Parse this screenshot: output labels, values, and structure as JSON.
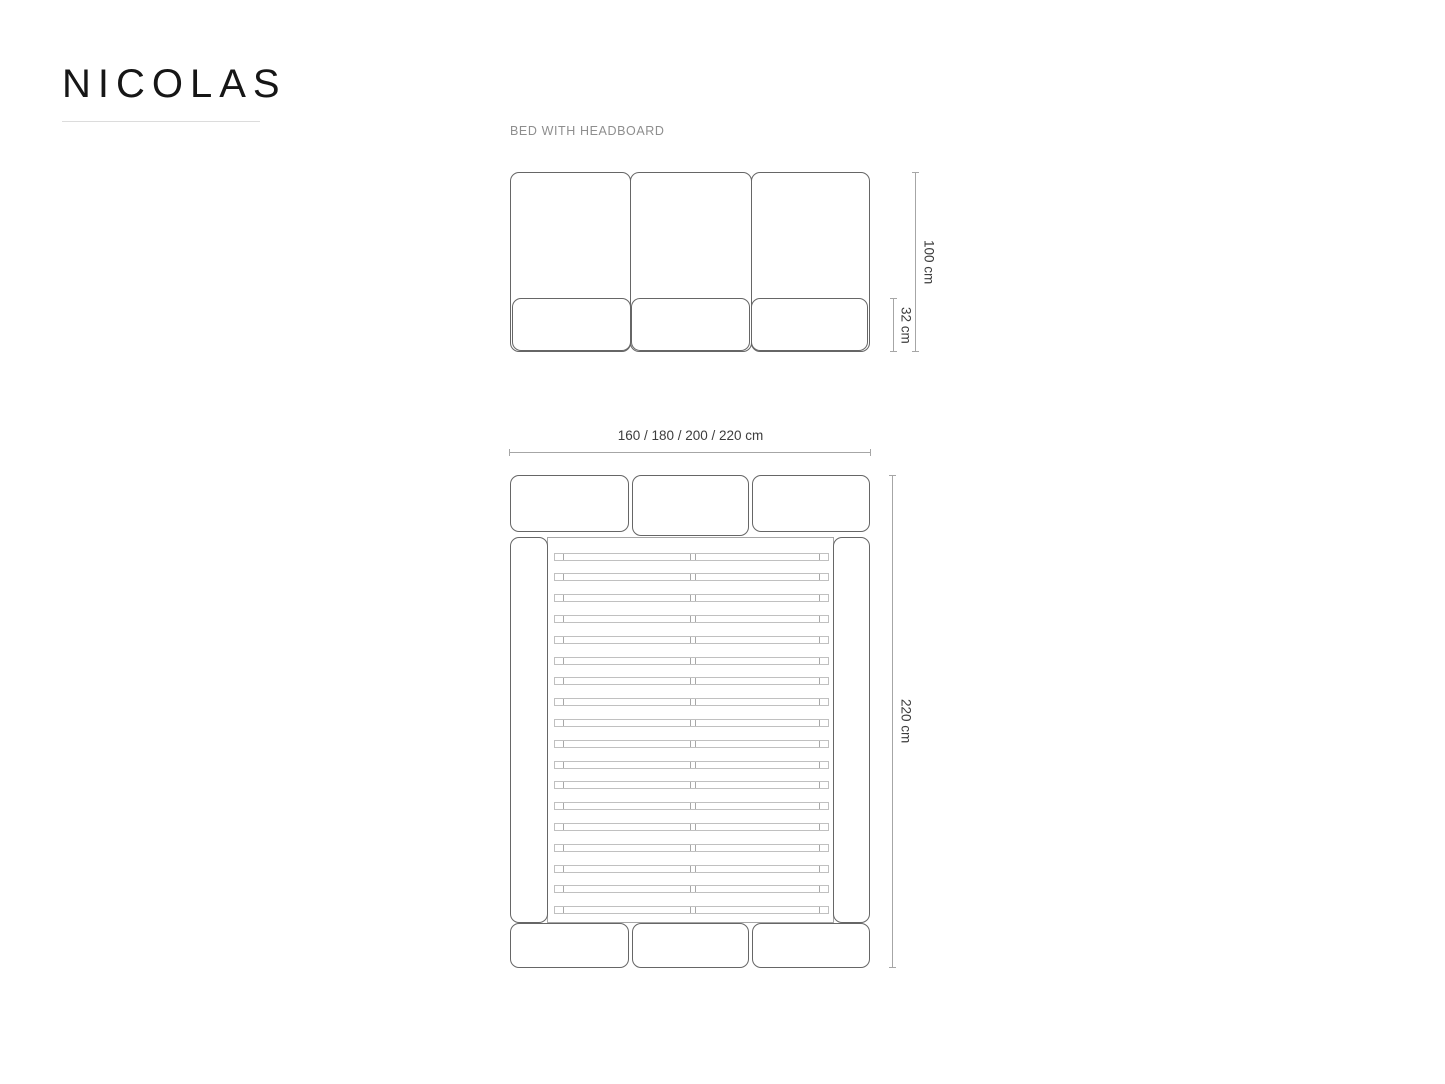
{
  "brand": {
    "name": "NICOLAS"
  },
  "product": {
    "label": "BED WITH HEADBOARD"
  },
  "front_view": {
    "total_height": "100 cm",
    "base_height": "32 cm"
  },
  "top_view": {
    "width_options": "160 / 180 / 200 / 220 cm",
    "length": "220 cm",
    "slat_count": 18
  },
  "colors": {
    "brand": "#161616",
    "outline": "#666666",
    "dim": "#a6a6a6",
    "slat": "#c0c0c0",
    "slatcap": "#a8a8a8",
    "text": "#3d3d3d",
    "muted": "#8e8e8e",
    "rule": "#dcdcdc"
  }
}
